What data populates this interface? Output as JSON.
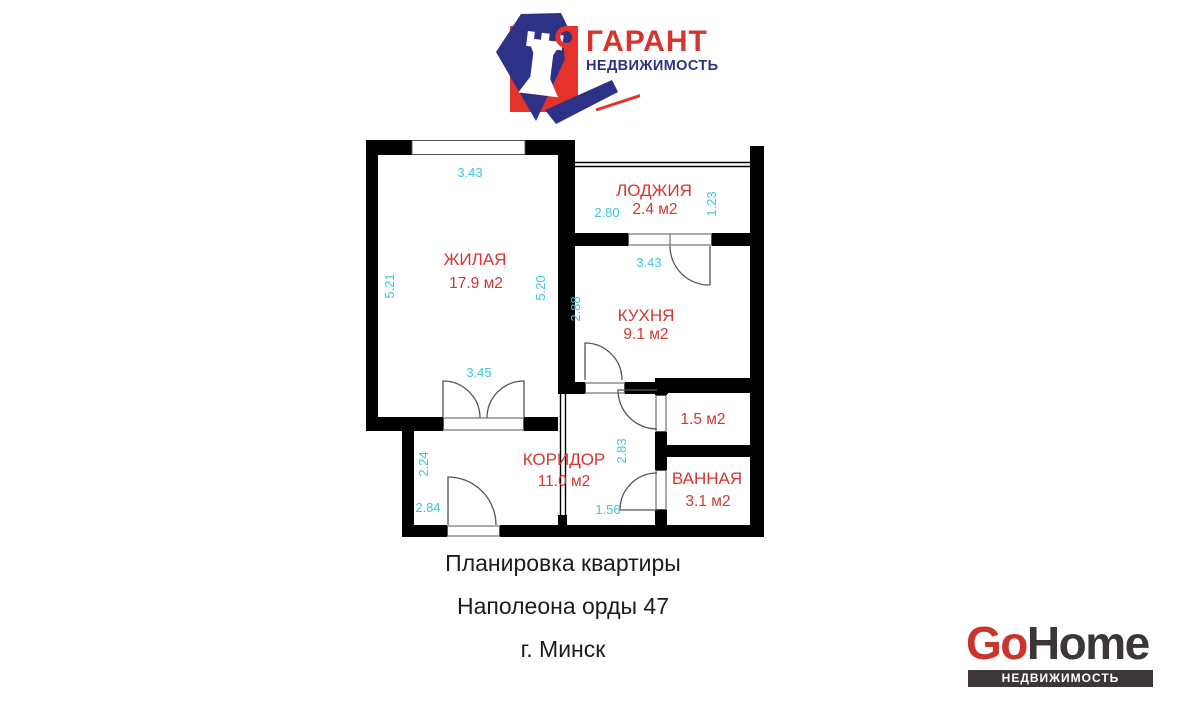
{
  "header": {
    "brand": "ГАРАНТ",
    "subtitle": "НЕДВИЖИМОСТЬ"
  },
  "floorplan": {
    "labels": [
      {
        "t": "ЖИЛАЯ",
        "x": 475,
        "y": 265,
        "c": "room"
      },
      {
        "t": "17.9 м2",
        "x": 476,
        "y": 288,
        "c": "area"
      },
      {
        "t": "ЛОДЖИЯ",
        "x": 654,
        "y": 196,
        "c": "room"
      },
      {
        "t": "2.4 м2",
        "x": 655,
        "y": 214,
        "c": "area"
      },
      {
        "t": "КУХНЯ",
        "x": 646,
        "y": 321,
        "c": "room"
      },
      {
        "t": "9.1 м2",
        "x": 646,
        "y": 339,
        "c": "area"
      },
      {
        "t": "КОРИДОР",
        "x": 564,
        "y": 465,
        "c": "room"
      },
      {
        "t": "11.0 м2",
        "x": 564,
        "y": 486,
        "c": "area"
      },
      {
        "t": "1.5 м2",
        "x": 703,
        "y": 424,
        "c": "area"
      },
      {
        "t": "ВАННАЯ",
        "x": 707,
        "y": 484,
        "c": "room"
      },
      {
        "t": "3.1 м2",
        "x": 708,
        "y": 506,
        "c": "area"
      },
      {
        "t": "3.43",
        "x": 470,
        "y": 177,
        "c": "dim"
      },
      {
        "t": "5.21",
        "x": 394,
        "y": 286,
        "c": "dim",
        "r": -90
      },
      {
        "t": "5.20",
        "x": 545,
        "y": 288,
        "c": "dim",
        "r": -90
      },
      {
        "t": "3.45",
        "x": 479,
        "y": 377,
        "c": "dim"
      },
      {
        "t": "2.80",
        "x": 607,
        "y": 217,
        "c": "dim"
      },
      {
        "t": "1.23",
        "x": 716,
        "y": 204,
        "c": "dim",
        "r": -90
      },
      {
        "t": "3.43",
        "x": 649,
        "y": 267,
        "c": "dim"
      },
      {
        "t": "2.88",
        "x": 580,
        "y": 309,
        "c": "dim",
        "r": -90
      },
      {
        "t": "2.24",
        "x": 428,
        "y": 464,
        "c": "dim",
        "r": -90
      },
      {
        "t": "2.84",
        "x": 428,
        "y": 512,
        "c": "dim"
      },
      {
        "t": "2.83",
        "x": 626,
        "y": 451,
        "c": "dim",
        "r": -90
      },
      {
        "t": "1.56",
        "x": 608,
        "y": 514,
        "c": "dim"
      }
    ]
  },
  "caption": {
    "line1": "Планировка квартиры",
    "line2": "Наполеона орды 47",
    "line3": "г. Минск"
  },
  "footer": {
    "brand_go": "Go",
    "brand_home": "Home",
    "tagline": "НЕДВИЖИМОСТЬ БЕЛАРУСИ"
  },
  "colors": {
    "room_label": "#d6352f",
    "dimension_label": "#3cc7db",
    "wall": "#000000",
    "logo_red": "#e5332b",
    "logo_navy": "#2d3287",
    "gohome_red": "#c9342c",
    "gohome_dark": "#3b3738"
  }
}
